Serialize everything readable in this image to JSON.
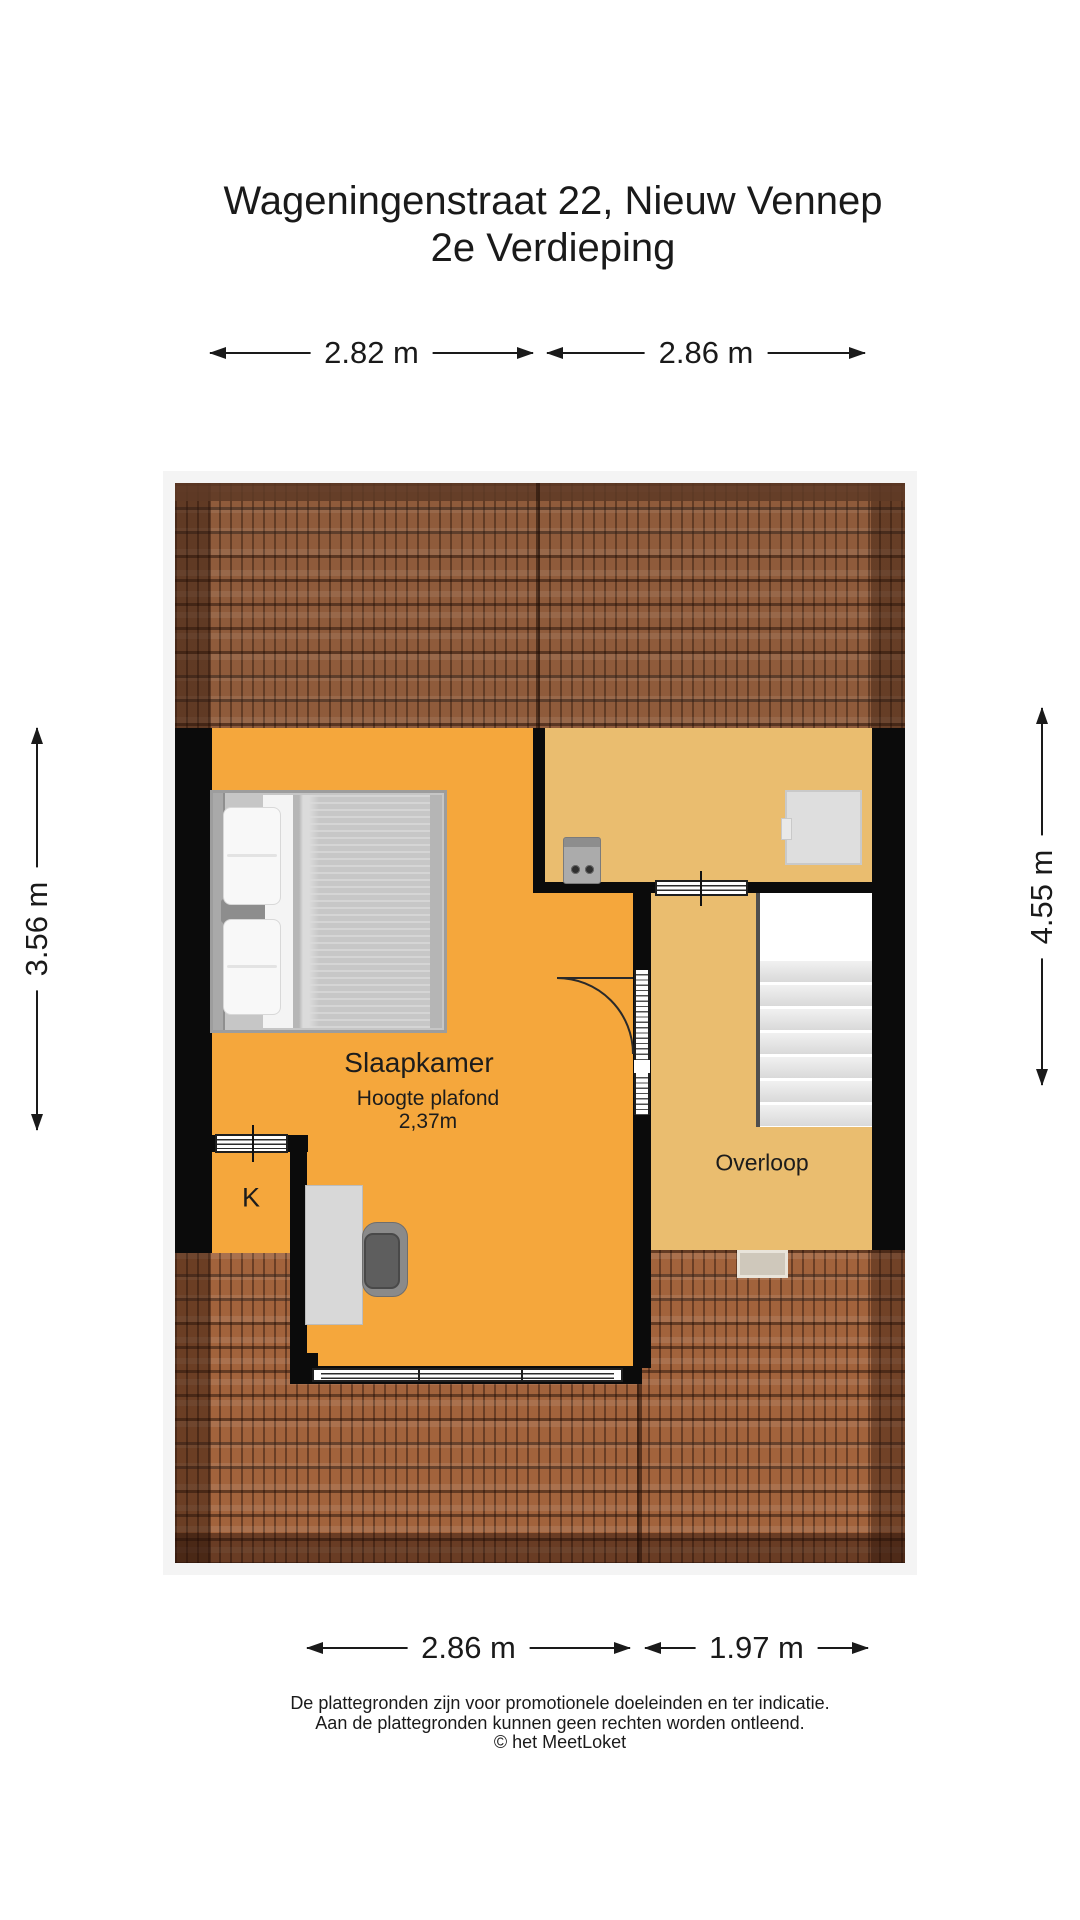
{
  "title": {
    "line1": "Wageningenstraat 22, Nieuw Vennep",
    "line2": "2e Verdieping"
  },
  "dimensions": {
    "top_left_width": "2.82 m",
    "top_right_width": "2.86 m",
    "left_height": "3.56 m",
    "right_height": "4.55 m",
    "bottom_left_width": "2.86 m",
    "bottom_right_width": "1.97 m"
  },
  "rooms": {
    "slaapkamer": {
      "label": "Slaapkamer",
      "ceiling_height_label": "Hoogte plafond",
      "ceiling_height_value": "2,37m"
    },
    "overloop": {
      "label": "Overloop"
    },
    "kast": {
      "label": "K"
    }
  },
  "footer": {
    "line1": "De plattegronden zijn voor promotionele doeleinden en ter indicatie.",
    "line2": "Aan de plattegronden kunnen geen rechten worden ontleend.",
    "line3": "© het MeetLoket"
  },
  "colors": {
    "bedroom_floor": "#F5A73C",
    "landing_floor": "#EABD6F",
    "wall": "#0B0B0B",
    "roof_top": "#8F5B3B",
    "roof_bottom": "#A2633C",
    "roof_ridge": "#5E3A26",
    "text": "#1A1A1A"
  }
}
